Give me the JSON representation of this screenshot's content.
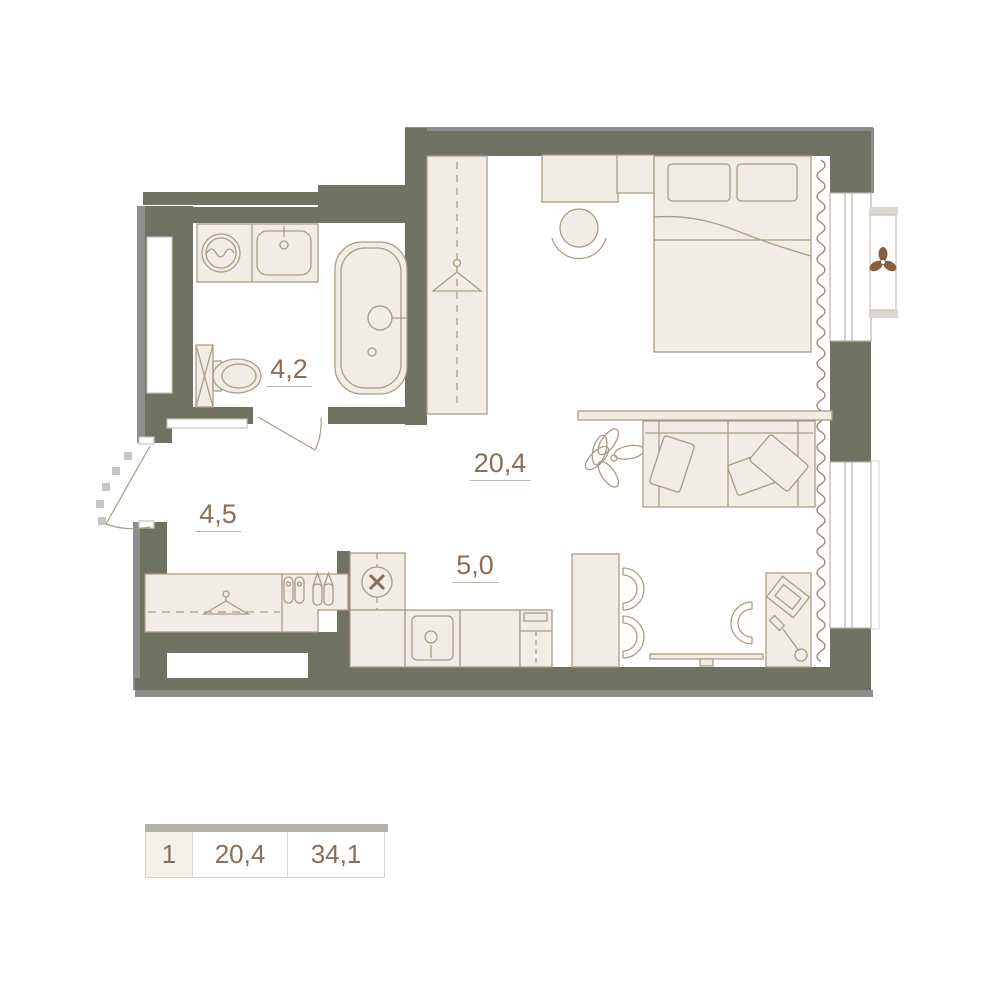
{
  "floor_plan": {
    "rooms": {
      "bathroom": {
        "name": "bathroom",
        "area": "4,2"
      },
      "hallway": {
        "name": "hallway",
        "area": "4,5"
      },
      "living_room": {
        "name": "living-room",
        "area": "20,4"
      },
      "kitchen": {
        "name": "kitchen",
        "area": "5,0"
      }
    },
    "summary": {
      "unit_number": "1",
      "living_area": "20,4",
      "total_area": "34,1"
    },
    "icons": {
      "hanger": "clothes-hanger",
      "fan": "propeller-fan",
      "plant": "plant-top-view",
      "shoes": "shoe-pairs",
      "washer": "washing-machine-drum",
      "hob": "circle-cross-hob",
      "laptop": "laptop-top-view",
      "lamp": "desk-lamp"
    },
    "colors": {
      "floor": "#ffffff",
      "wall": "#6f7261",
      "wall_shadow": "#8d8d8d",
      "furniture_fill": "#efede5",
      "furniture_stroke": "#ac9b85",
      "line_light": "#c9c2b4",
      "window_frame": "#b9b4aa",
      "cap": "#dbd8d2",
      "curtain": "#9c8a76",
      "fan": "#8a5f3f",
      "label_text": "#8a6e57",
      "label_underline": "#c4b29c",
      "legend_bar": "#b3afa9",
      "legend_border": "#d7d4ce",
      "legend_cell_bg": "#f4f1ea"
    }
  }
}
